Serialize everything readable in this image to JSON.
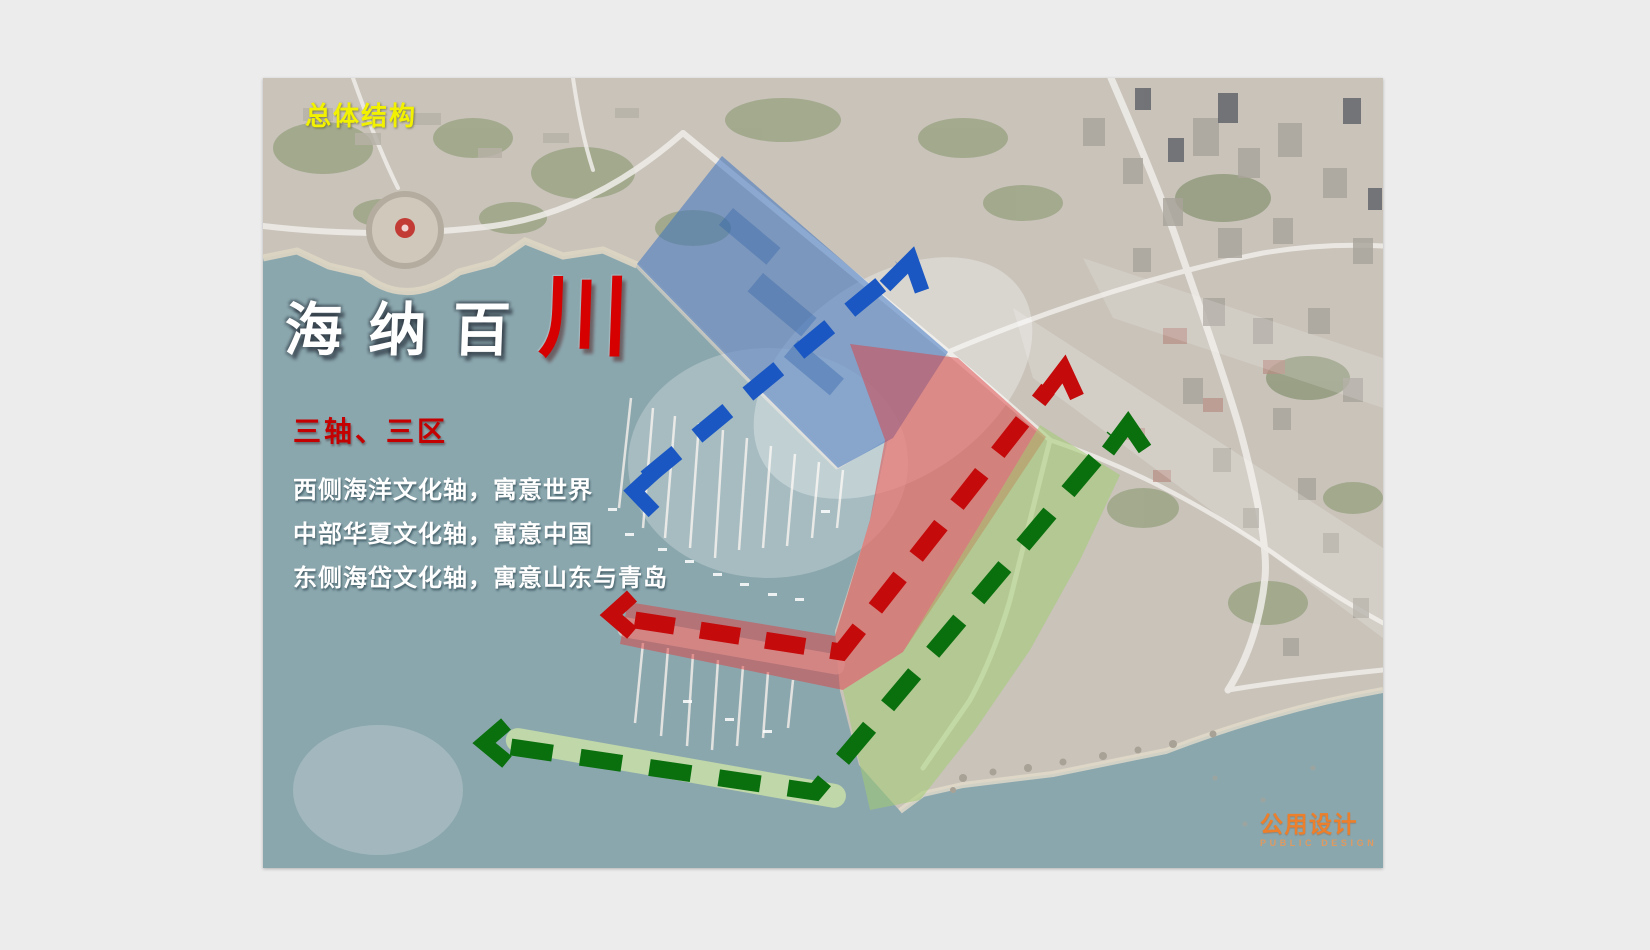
{
  "slide": {
    "corner_label": "总体结构",
    "title": {
      "white": "海纳百",
      "red": "川"
    },
    "legend": {
      "heading": "三轴、三区",
      "lines": [
        "西侧海洋文化轴，寓意世界",
        "中部华夏文化轴，寓意中国",
        "东侧海岱文化轴，寓意山东与青岛"
      ]
    },
    "logo": {
      "cn": "公用设计",
      "en": "PUBLIC DESIGN"
    },
    "map": {
      "water_color": "#8ba7ae",
      "land_color": "#c9c3ba",
      "breakwater_color": "#c8dfa8",
      "zones": [
        {
          "id": "west-blue-zone",
          "color": "#3570bf"
        },
        {
          "id": "central-red-zone",
          "color": "#dd4040"
        },
        {
          "id": "east-green-zone",
          "color": "#a2cc72"
        }
      ],
      "axes": [
        {
          "id": "west-marine-axis",
          "color": "#1a57c2"
        },
        {
          "id": "central-huaxia-axis",
          "color": "#c40a0a"
        },
        {
          "id": "east-haidai-axis",
          "color": "#0a700d"
        }
      ]
    }
  }
}
